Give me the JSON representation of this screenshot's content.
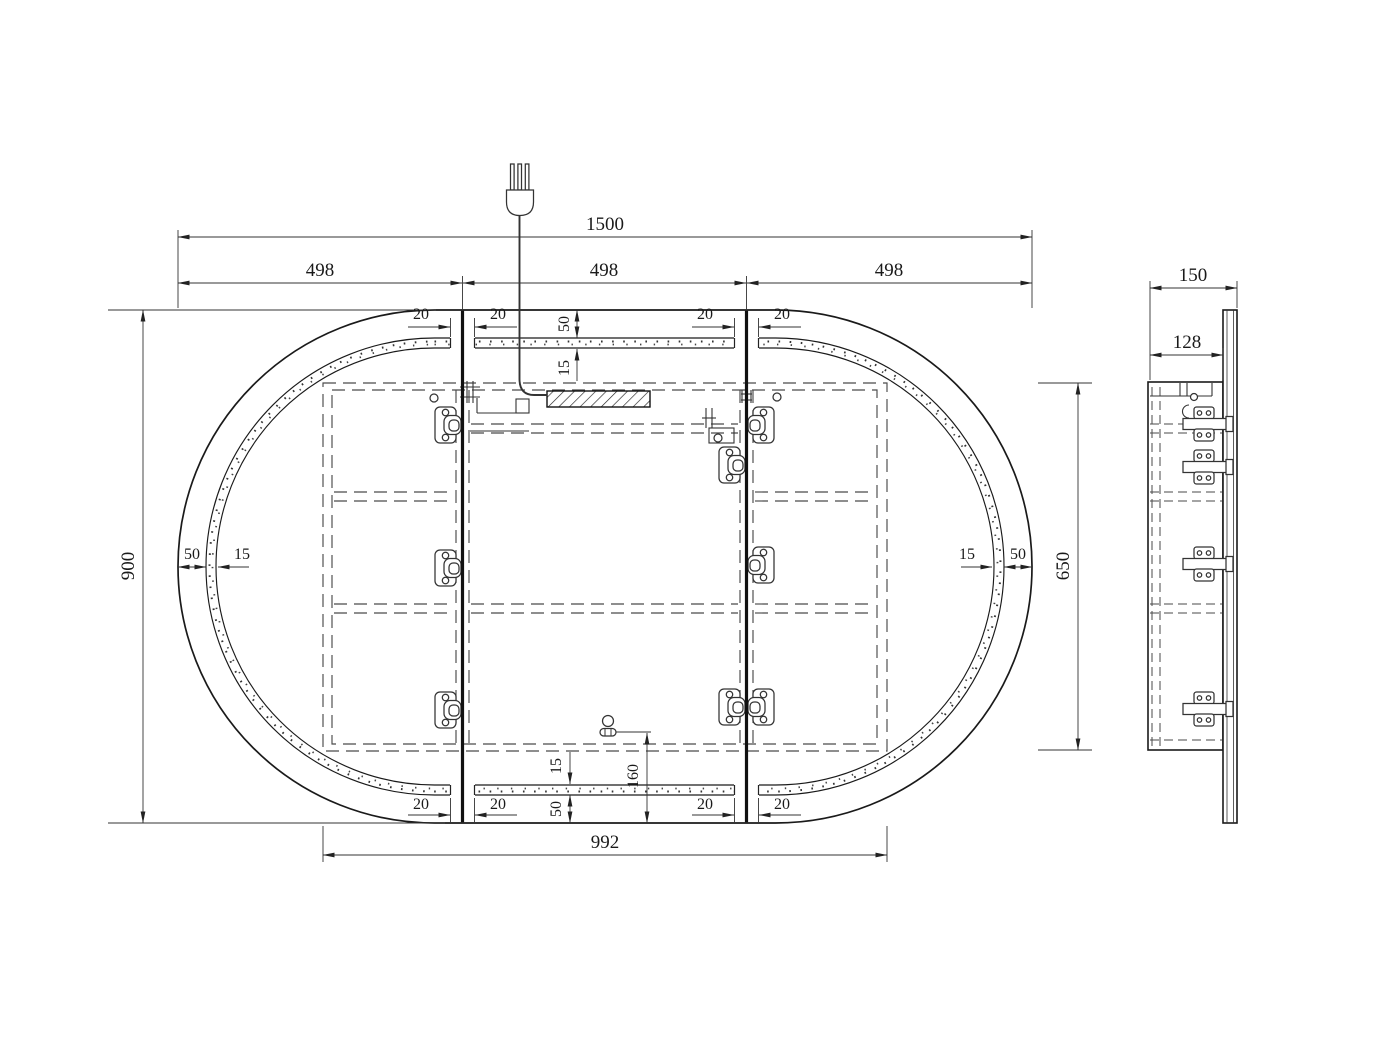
{
  "meta": {
    "drawing_type": "technical drawing",
    "subject": "Oval LED mirror cabinet - front and side elevation with dimensions (mm)"
  },
  "front_view": {
    "overall_width": "1500",
    "door_width_left": "498",
    "door_width_center": "498",
    "door_width_right": "498",
    "overall_height": "900",
    "carcass_width": "992",
    "carcass_height": "650",
    "frame_border": "50",
    "led_strip": "15",
    "door_gap": "20",
    "sensor_offset": "160"
  },
  "side_view": {
    "overall_depth": "150",
    "carcass_depth": "128"
  }
}
